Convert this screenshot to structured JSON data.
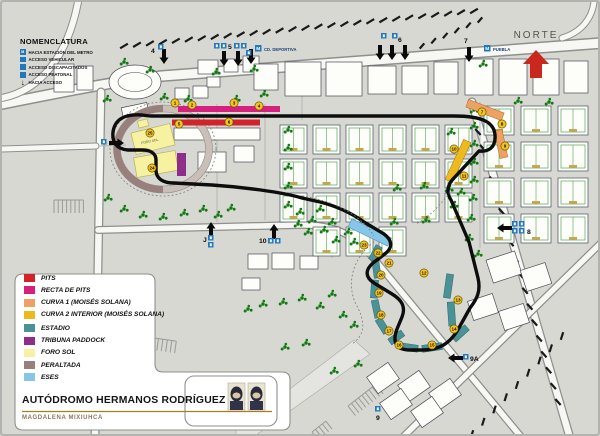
{
  "map": {
    "north_label": "NORTE",
    "nomenclatura": {
      "title": "NOMENCLATURA",
      "items": [
        {
          "icon": "metro-icon",
          "label": "HACIA ESTACIÓN DEL METRO"
        },
        {
          "icon": "vehicle-access-icon",
          "label": "ACCESO VEHICULAR"
        },
        {
          "icon": "disabled-access-icon",
          "label": "ACCESO DISCAPACITADOS"
        },
        {
          "icon": "pedestrian-access-icon",
          "label": "ACCESO PEATONAL"
        },
        {
          "icon": "gate-arrow-icon",
          "label": "HACIA ACCESO"
        }
      ]
    },
    "metro_stations": [
      {
        "name": "CD. DEPORTIVA",
        "mx": 253,
        "my": 43,
        "tx": 262,
        "ty": 49
      },
      {
        "name": "PUEBLA",
        "mx": 482,
        "my": 43,
        "tx": 491,
        "ty": 49
      }
    ],
    "gates": [
      {
        "label": "4",
        "lx": 149,
        "ly": 51,
        "dir": "down",
        "arrows": [
          [
            162,
            62
          ]
        ],
        "icons": [
          [
            156,
            42
          ]
        ]
      },
      {
        "label": "5",
        "lx": 226,
        "ly": 47,
        "dir": "down",
        "arrows": [
          [
            222,
            64
          ],
          [
            236,
            64
          ],
          [
            249,
            62
          ]
        ],
        "icons": [
          [
            212,
            41
          ],
          [
            219,
            41
          ],
          [
            232,
            41
          ],
          [
            239,
            41
          ],
          [
            244,
            48
          ]
        ]
      },
      {
        "label": "6",
        "lx": 396,
        "ly": 40,
        "dir": "down",
        "arrows": [
          [
            378,
            58
          ],
          [
            390,
            58
          ],
          [
            403,
            58
          ]
        ],
        "icons": [
          [
            379,
            31
          ],
          [
            390,
            31
          ]
        ]
      },
      {
        "label": "7",
        "lx": 462,
        "ly": 41,
        "dir": "down",
        "arrows": [
          [
            467,
            60
          ]
        ],
        "icons": []
      },
      {
        "label": "8",
        "lx": 525,
        "ly": 232,
        "dir": "left",
        "arrows": [
          [
            495,
            226
          ]
        ],
        "icons": [
          [
            510,
            219
          ],
          [
            517,
            219
          ],
          [
            510,
            226
          ],
          [
            517,
            226
          ]
        ]
      },
      {
        "label": "9A",
        "lx": 468,
        "ly": 359,
        "dir": "left",
        "arrows": [
          [
            446,
            356
          ]
        ],
        "icons": [
          [
            461,
            352
          ]
        ]
      },
      {
        "label": "9",
        "lx": 374,
        "ly": 418,
        "dir": "none",
        "arrows": [],
        "icons": [
          [
            373,
            404
          ]
        ]
      },
      {
        "label": "10",
        "lx": 257,
        "ly": 241,
        "dir": "up",
        "arrows": [
          [
            272,
            222
          ]
        ],
        "icons": [
          [
            266,
            236
          ],
          [
            273,
            236
          ]
        ]
      },
      {
        "label": "J",
        "lx": 201,
        "ly": 240,
        "dir": "up",
        "arrows": [
          [
            209,
            220
          ]
        ],
        "icons": [
          [
            206,
            233
          ],
          [
            206,
            240
          ]
        ]
      },
      {
        "label": "",
        "lx": 0,
        "ly": 0,
        "dir": "right",
        "arrows": [
          [
            122,
            141
          ]
        ],
        "icons": [
          [
            99,
            137
          ]
        ]
      }
    ],
    "markers": [
      {
        "n": "1",
        "x": 173,
        "y": 101
      },
      {
        "n": "2",
        "x": 190,
        "y": 103
      },
      {
        "n": "3",
        "x": 232,
        "y": 101
      },
      {
        "n": "4",
        "x": 257,
        "y": 104
      },
      {
        "n": "5",
        "x": 177,
        "y": 122
      },
      {
        "n": "6",
        "x": 227,
        "y": 120
      },
      {
        "n": "7",
        "x": 480,
        "y": 110
      },
      {
        "n": "8",
        "x": 500,
        "y": 122
      },
      {
        "n": "9",
        "x": 503,
        "y": 144
      },
      {
        "n": "10",
        "x": 452,
        "y": 147
      },
      {
        "n": "11",
        "x": 462,
        "y": 174
      },
      {
        "n": "12",
        "x": 422,
        "y": 271
      },
      {
        "n": "13",
        "x": 456,
        "y": 298
      },
      {
        "n": "14",
        "x": 452,
        "y": 327
      },
      {
        "n": "15",
        "x": 430,
        "y": 343
      },
      {
        "n": "16",
        "x": 397,
        "y": 343
      },
      {
        "n": "17",
        "x": 387,
        "y": 329
      },
      {
        "n": "18",
        "x": 379,
        "y": 313
      },
      {
        "n": "19",
        "x": 377,
        "y": 291
      },
      {
        "n": "20",
        "x": 379,
        "y": 273
      },
      {
        "n": "21",
        "x": 387,
        "y": 261
      },
      {
        "n": "22",
        "x": 376,
        "y": 251
      },
      {
        "n": "23",
        "x": 362,
        "y": 243
      },
      {
        "n": "24",
        "x": 150,
        "y": 166
      },
      {
        "n": "25",
        "x": 148,
        "y": 131
      }
    ],
    "venue_labels": {
      "foro_sol": "FORO SOL"
    }
  },
  "legend": {
    "items": [
      {
        "label": "PITS",
        "color": "#d3222a"
      },
      {
        "label": "RECTA DE PITS",
        "color": "#d6207e"
      },
      {
        "label": "CURVA 1 (MOISÉS SOLANA)",
        "color": "#eda263"
      },
      {
        "label": "CURVA 2 INTERIOR (MOISÉS SOLANA)",
        "color": "#edb91c"
      },
      {
        "label": "ESTADIO",
        "color": "#4a9296"
      },
      {
        "label": "TRIBUNA PADDOCK",
        "color": "#8e2d8c"
      },
      {
        "label": "FORO SOL",
        "color": "#f6f2a2"
      },
      {
        "label": "PERALTADA",
        "color": "#99807d"
      },
      {
        "label": "ESES",
        "color": "#85c6e9"
      }
    ],
    "title": "AUTÓDROMO HERMANOS RODRÍGUEZ",
    "subtitle": "MAGDALENA MIXIUHCA"
  },
  "colors": {
    "metro_blue": "#2278bc",
    "norte_red": "#c8281e",
    "track": "#0d0d0d",
    "marker_yellow": "#f6c51d"
  }
}
